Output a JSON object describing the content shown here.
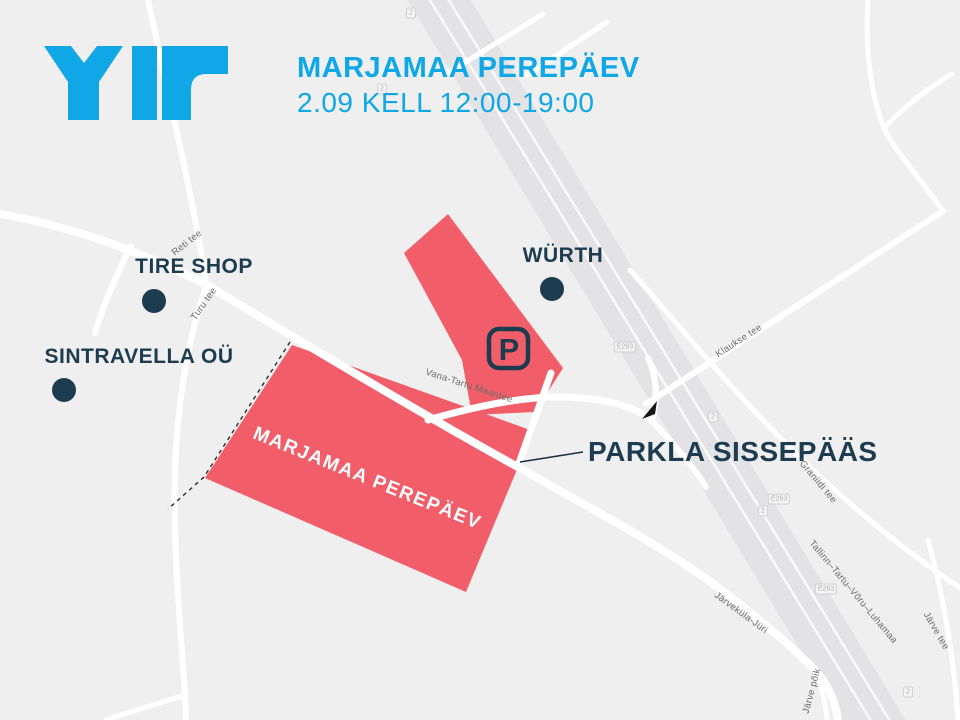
{
  "header": {
    "logo": "YIT",
    "title": "MARJAMAA PEREPÄEV",
    "subtitle": "2.09 KELL 12:00-19:00",
    "brand_color": "#0FA7E6"
  },
  "map": {
    "colors": {
      "background": "#EFEFEF",
      "road": "#FFFFFF",
      "highway": "#E3E3E5",
      "event_area": "#F15E69",
      "marker": "#1E3C50",
      "road_label": "#6B6B6B"
    },
    "areas": {
      "event": {
        "label": "MARJAMAA PEREPÄEV"
      },
      "parking": {
        "letter": "P"
      }
    },
    "pois": [
      {
        "label": "TIRE SHOP"
      },
      {
        "label": "SINTRAVELLA OÜ"
      },
      {
        "label": "WÜRTH"
      }
    ],
    "callout": {
      "label": "PARKLA SISSEPÄÄS"
    },
    "road_labels": [
      {
        "text": "Reti tee"
      },
      {
        "text": "Turu tee"
      },
      {
        "text": "Vana-Tartu Maantee"
      },
      {
        "text": "Klaukse tee"
      },
      {
        "text": "Graniidi tee"
      },
      {
        "text": "Tallinn–Tartu–Võru–Luhamaa"
      },
      {
        "text": "Järveküla-Jüri"
      },
      {
        "text": "Järve tee"
      },
      {
        "text": "Järve põik"
      }
    ],
    "shields": [
      {
        "text": "2"
      },
      {
        "text": "2"
      },
      {
        "text": "E263"
      },
      {
        "text": "2"
      },
      {
        "text": "E263"
      },
      {
        "text": "2"
      },
      {
        "text": "E263"
      },
      {
        "text": "2"
      }
    ]
  }
}
